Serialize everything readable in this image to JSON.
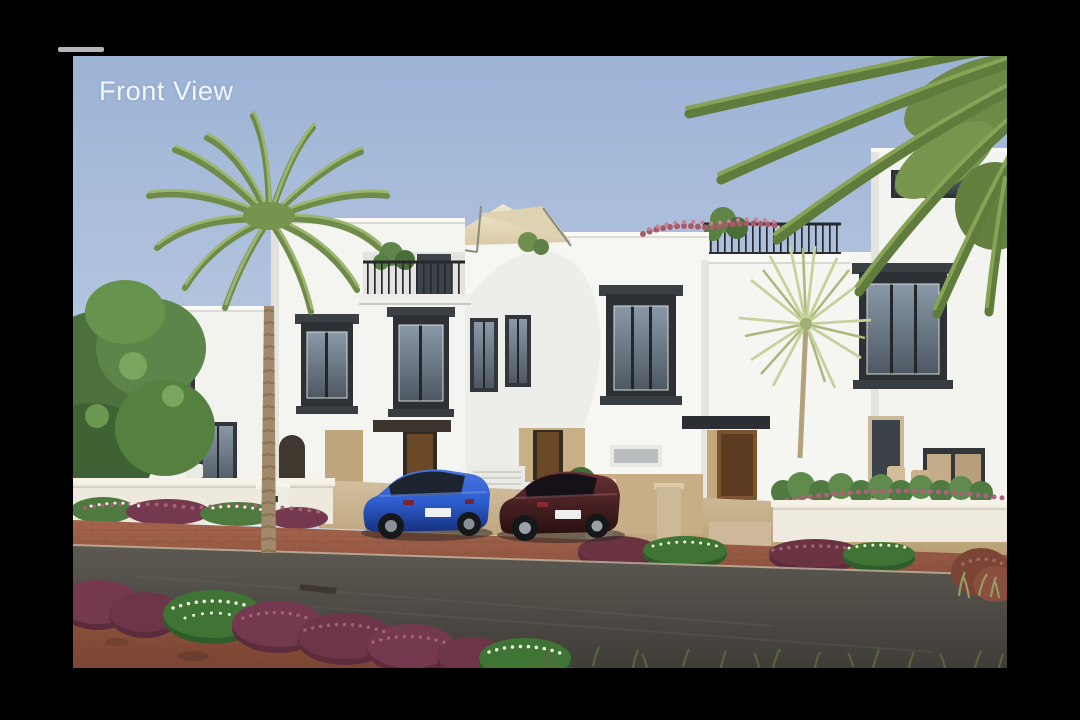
{
  "overlay": {
    "title": "Front View"
  },
  "scene": {
    "kind": "architectural exterior rendering, front elevation of modern white townhouses",
    "elements": [
      "white townhouse row",
      "roof terrace with shade sail",
      "balcony railings",
      "dark bay windows",
      "date palm",
      "fan palm",
      "overhanging palm fronds",
      "leafy tree",
      "blue sedan",
      "maroon sedan",
      "wooden entry doors",
      "flower hedges",
      "brick pavement",
      "asphalt road",
      "low garden walls"
    ],
    "palette": {
      "frame": "#000000",
      "sky": "#a6bcdc",
      "walls": "#f3f3f0",
      "window_frames": "#2f3337",
      "brick_road": "#9a5c46",
      "asphalt": "#4a4642",
      "hedge_purple": "#6d3648",
      "hedge_green": "#3b6e33",
      "palm_green": "#86a258",
      "car_blue": "#2e5fd0",
      "car_maroon": "#57242a",
      "shade_sail": "#e9ddc2"
    }
  }
}
